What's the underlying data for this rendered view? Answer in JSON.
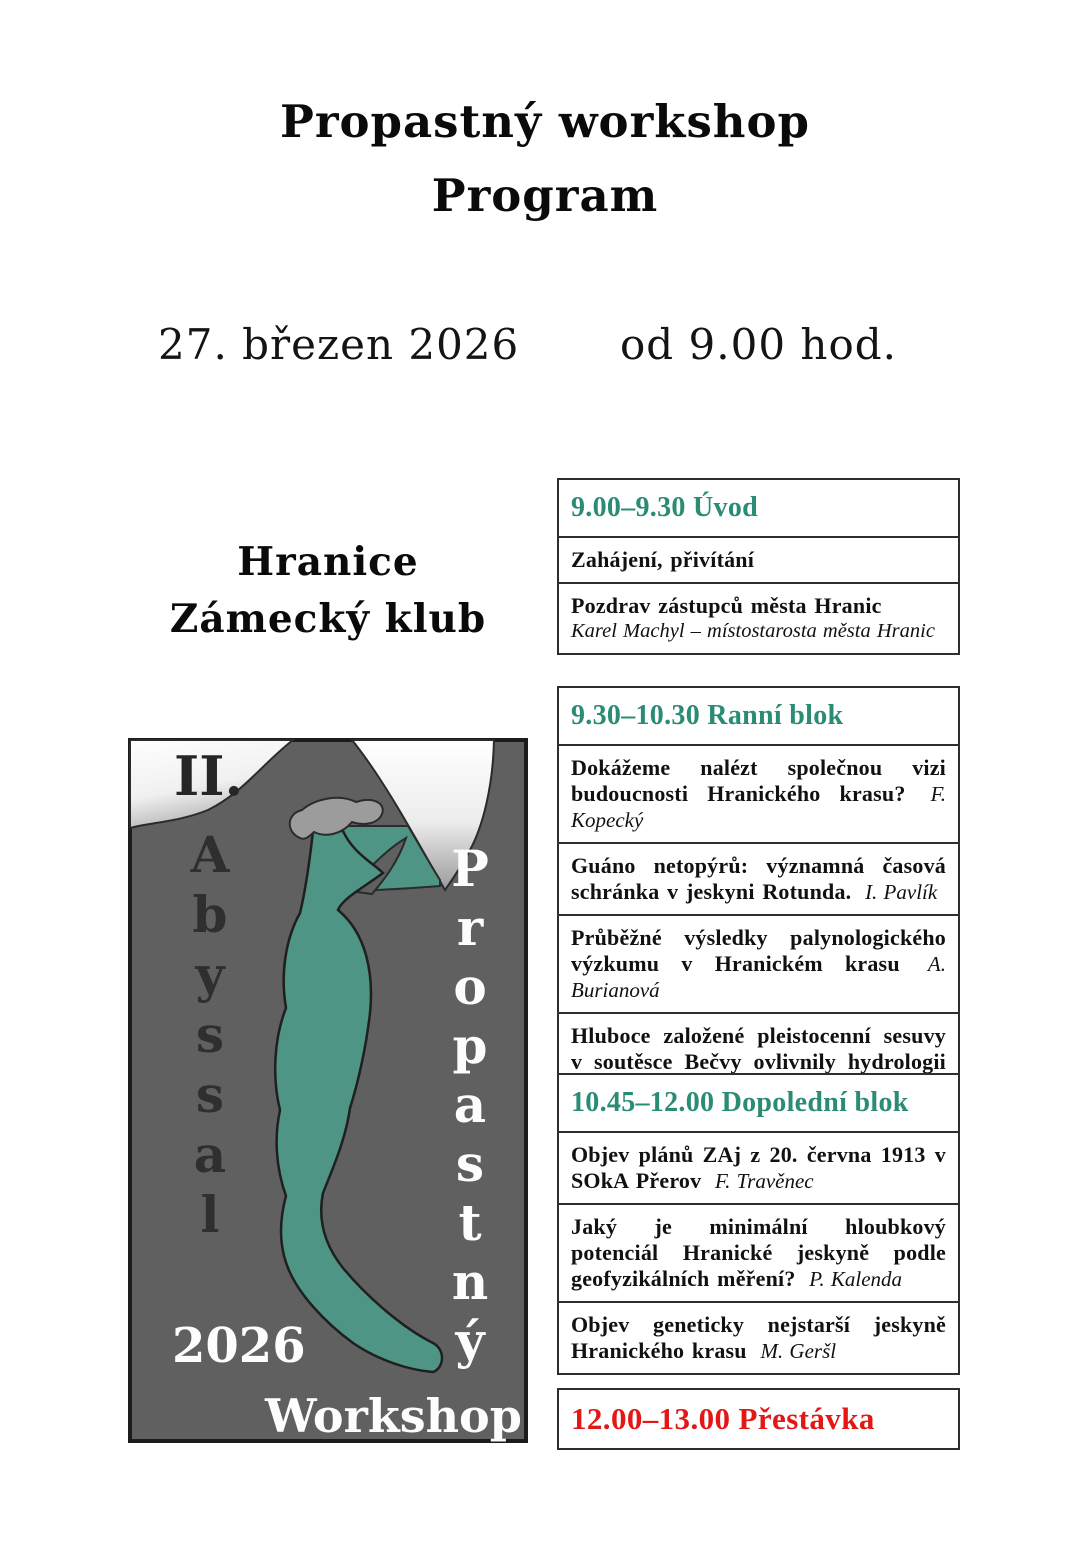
{
  "document": {
    "title": "Propastný workshop",
    "subtitle": "Program",
    "date": "27. březen 2026",
    "time": "od 9.00 hod.",
    "venue_line1": "Hranice",
    "venue_line2": "Zámecký klub"
  },
  "logo": {
    "edition": "II.",
    "vertical_left": "Abyssal",
    "vertical_right": "Propastný",
    "year": "2026",
    "caption": "Workshop",
    "colors": {
      "background": "#606060",
      "cave_teal": "#4e9585",
      "surface_light": "#ffffff",
      "hammer_gray": "#9c9c9c"
    }
  },
  "colors": {
    "block_heading_teal": "#2a8c75",
    "break_red": "#e41717",
    "table_border": "#2e2e2e",
    "body_text": "#111111"
  },
  "schedule": {
    "blocks": [
      {
        "heading": "9.00–9.30 Úvod",
        "items": [
          {
            "title": "Zahájení, přivítání",
            "author": ""
          },
          {
            "title": "Pozdrav zástupců města Hranic",
            "author": "Karel Machyl – místostarosta města Hranic"
          }
        ]
      },
      {
        "heading": "9.30–10.30 Ranní blok",
        "items": [
          {
            "title": "Dokážeme nalézt společnou vizi budoucnosti Hranického krasu?",
            "author": "F. Kopecký"
          },
          {
            "title": "Guáno netopýrů: významná časová schránka v jeskyni Rotunda.",
            "author": "I. Pavlík"
          },
          {
            "title": "Průběžné výsledky palynologického výzkumu v Hranickém krasu",
            "author": "A. Burianová"
          },
          {
            "title": "Hluboce založené pleistocenní sesuvy v soutěsce Bečvy ovlivnily hydrologii Zbrašovských jeskyní",
            "author": "I. Baroň"
          }
        ]
      },
      {
        "heading": "10.45–12.00 Dopolední blok",
        "items": [
          {
            "title": "Objev plánů ZAj z 20. června 1913 v SOkA Přerov",
            "author": "F. Travěnec"
          },
          {
            "title": "Jaký je minimální hloubkový potenciál Hranické jeskyně podle geofyzikálních měření?",
            "author": "P. Kalenda"
          },
          {
            "title": "Objev geneticky nejstarší jeskyně Hranického krasu",
            "author": "M. Geršl"
          }
        ]
      },
      {
        "heading": "12.00–13.00 Přestávka",
        "items": []
      }
    ]
  }
}
